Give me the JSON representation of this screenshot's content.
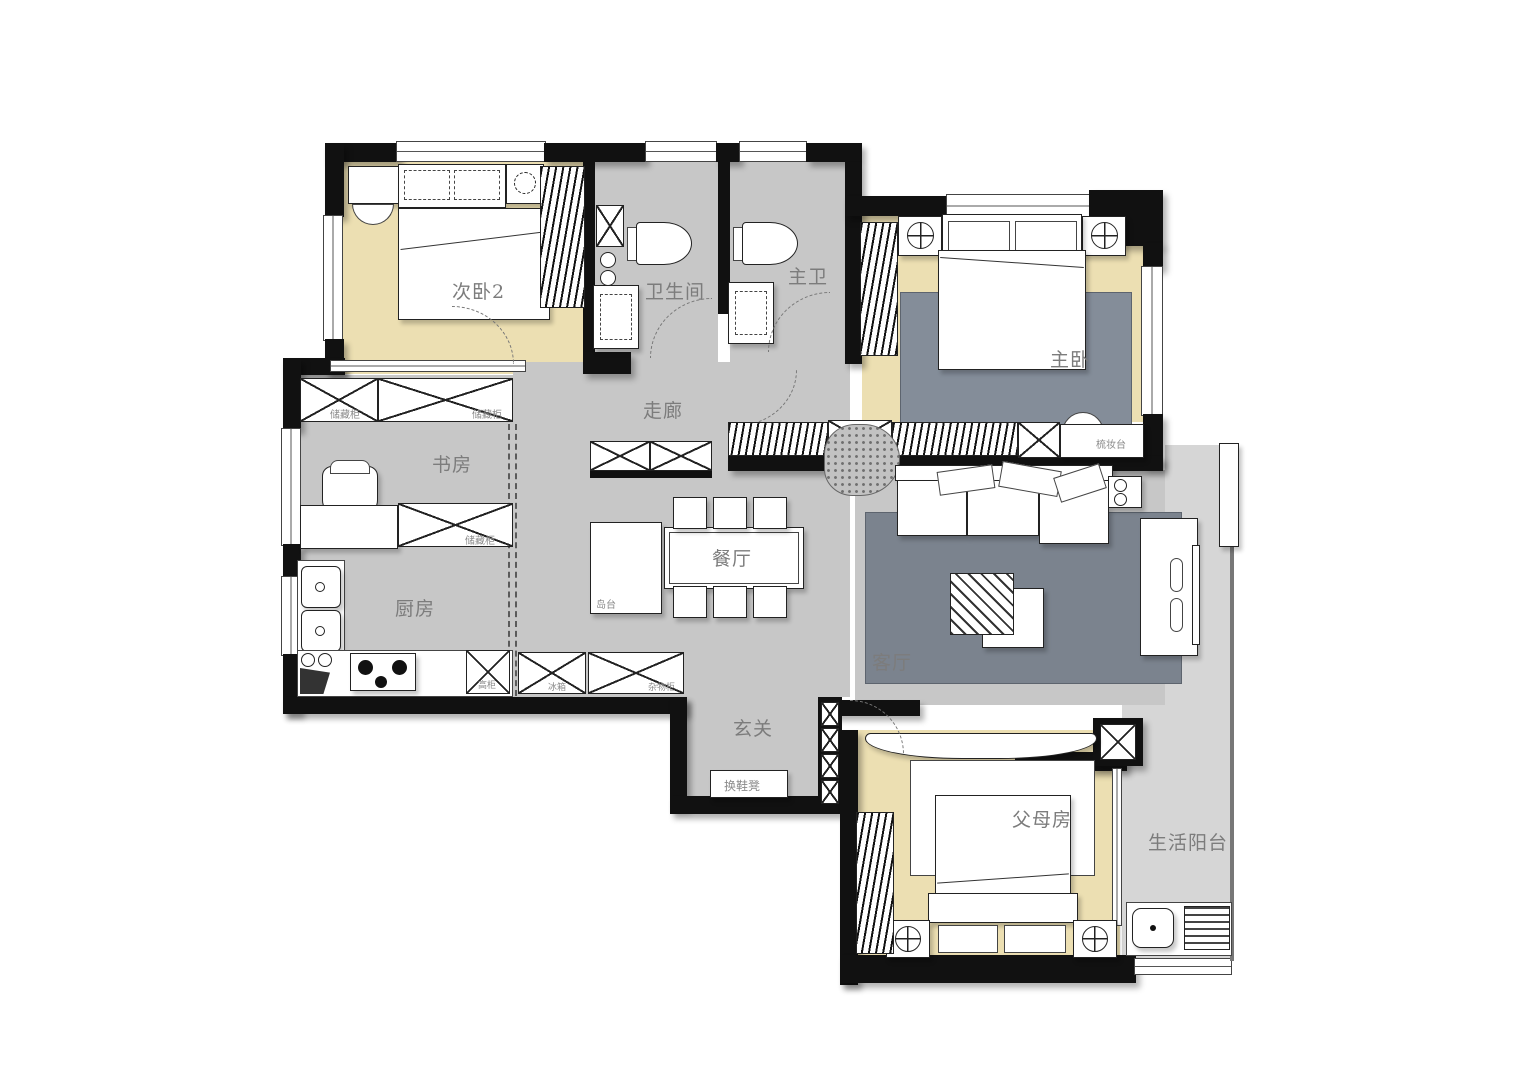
{
  "plan_title": "apartment-floor-plan",
  "rooms": {
    "bedroom2": "次卧2",
    "bathroom": "卫生间",
    "master_bath": "主卫",
    "master_bedroom": "主卧",
    "corridor": "走廊",
    "study": "书房",
    "kitchen": "厨房",
    "dining": "餐厅",
    "living": "客厅",
    "entry": "玄关",
    "parents_room": "父母房",
    "balcony": "生活阳台"
  },
  "furniture_labels": {
    "island": "岛台",
    "dresser": "梳妆台",
    "shoe_bench": "换鞋凳",
    "storage_cabinet_a": "储藏柜",
    "storage_cabinet_b": "储藏柜",
    "storage_cabinet_c": "储藏柜",
    "tall_cabinet": "高柜",
    "fridge": "冰箱",
    "sundries_cabinet": "杂物柜"
  },
  "colors": {
    "wall": "#111111",
    "floor_common": "#c7c7c7",
    "floor_bedroom": "#ecdfb2",
    "floor_balcony": "#d6d6d6",
    "rug": "#7b838e",
    "label": "#7c7c7c"
  }
}
